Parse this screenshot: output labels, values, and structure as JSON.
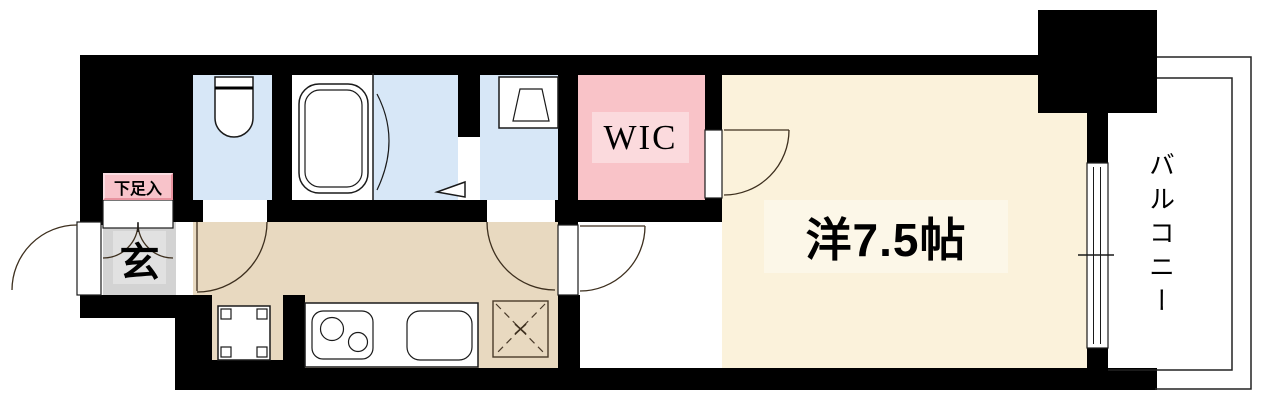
{
  "title": "1K apartment floor plan",
  "labels": {
    "shoe_storage": "下足入",
    "entrance": "玄",
    "wic": "WIC",
    "main_room": "洋7.5帖",
    "balcony": "バルコニー"
  },
  "rooms": [
    {
      "id": "entrance",
      "label": "玄",
      "floor_color": "#D3D3D3"
    },
    {
      "id": "toilet",
      "label": "",
      "floor_color": "#D7E7F7"
    },
    {
      "id": "bathroom",
      "label": "",
      "floor_color": "#D7E7F7"
    },
    {
      "id": "washroom",
      "label": "",
      "floor_color": "#D7E7F7"
    },
    {
      "id": "walk-in-closet",
      "label": "WIC",
      "floor_color": "#F9C3C8"
    },
    {
      "id": "kitchen-hallway",
      "label": "",
      "floor_color": "#E8D9C0"
    },
    {
      "id": "western-room",
      "label": "洋7.5帖",
      "floor_color": "#FBF2DB"
    },
    {
      "id": "balcony",
      "label": "バルコニー",
      "floor_color": "#FFFFFF"
    }
  ],
  "icons": [
    "toilet-icon",
    "bathtub-icon",
    "washbasin-icon",
    "kitchen-stove-icon",
    "kitchen-sink-icon",
    "fridge-space-icon",
    "washer-space-icon",
    "door-swing-icon",
    "folding-door-icon",
    "sliding-window-icon",
    "curtain-step-icon"
  ],
  "colors": {
    "wall": "#000000",
    "wet": "#D7E7F7",
    "tan": "#E8D9C0",
    "cream": "#FBF2DB",
    "creamLabel": "#FCF7E8",
    "pink": "#F9C3C8",
    "pinkLabel": "#FBDADD",
    "shoePink": "#F8C3CA",
    "shoeBorder": "#E8939F",
    "gray": "#D3D3D3",
    "grayInner": "#E1E1E1",
    "line": "#1a1a1a"
  }
}
